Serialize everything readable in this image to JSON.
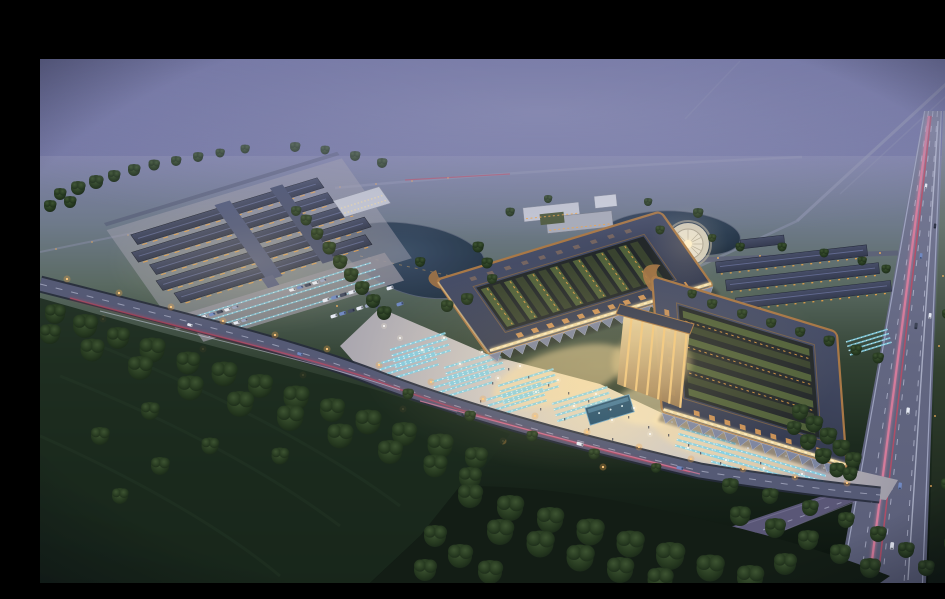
{
  "canvas": {
    "width": 945,
    "height": 567,
    "letterbox_top_px": 43
  },
  "scene": {
    "type": "architectural-aerial-rendering",
    "time_of_day": "dusk",
    "subject": "Aerial dusk rendering of a large twin-hall market complex with glowing courtyards, front plaza and parking, ponds with a circular fountain plaza, a secondary row-building complex, warehouse rows, an access road with street lights, a multi-lane highway with light trails, woodland and open fields under purple haze"
  },
  "palette": {
    "frame": "#000000",
    "sky_top": "#63679b",
    "sky_mid": "#7f82aa",
    "fog": "#9a9cbe",
    "haze_land": "#70798f",
    "distant_green": "#5a675f",
    "field_green": "#22301f",
    "field_dark": "#0c1410",
    "tree_dark": "#1a291c",
    "tree_mid": "#263a26",
    "tree_light": "#33492e",
    "road_dark": "#31364a",
    "road_mid": "#555a75",
    "road_light": "#9094b0",
    "highway_a": "#5c6078",
    "highway_b": "#6e6b8c",
    "lane_white": "#cdd1e6",
    "streak_pink": "#e27e9e",
    "streak_red": "#c04a62",
    "amber": "#f2a648",
    "glow_warm": "#ffe6ae",
    "facade_glow": "#f8e0a6",
    "plaza_a": "#cfc9c4",
    "plaza_b": "#a19fab",
    "plaza_warm": "#efddb4",
    "roof_slate_a": "#474e68",
    "roof_slate_b": "#353b50",
    "roof_copper": "#a87847",
    "courtyard_dark": "#23282a",
    "courtyard_green": "#50603a",
    "skylight_amber": "#e4a058",
    "water_a": "#31435a",
    "water_b": "#1f2d3f",
    "circle_plaza": "#d7d1c0",
    "teal": "#7fd0e6",
    "car_white": "#e6eaf4",
    "car_blue": "#7089c2",
    "white_building": "#c4c7d3"
  },
  "landmarks": [
    "letterbox-top",
    "sky",
    "distant-roads",
    "highway",
    "service-road",
    "left-market-complex",
    "west-market-hall",
    "east-market-hall",
    "entrance-atrium",
    "west-pond",
    "east-pond",
    "circular-plaza-fountain",
    "office-building-cluster",
    "warehouse-rows",
    "main-plaza",
    "reflecting-pool",
    "access-road",
    "roadside-trees",
    "woodland",
    "open-fields"
  ]
}
